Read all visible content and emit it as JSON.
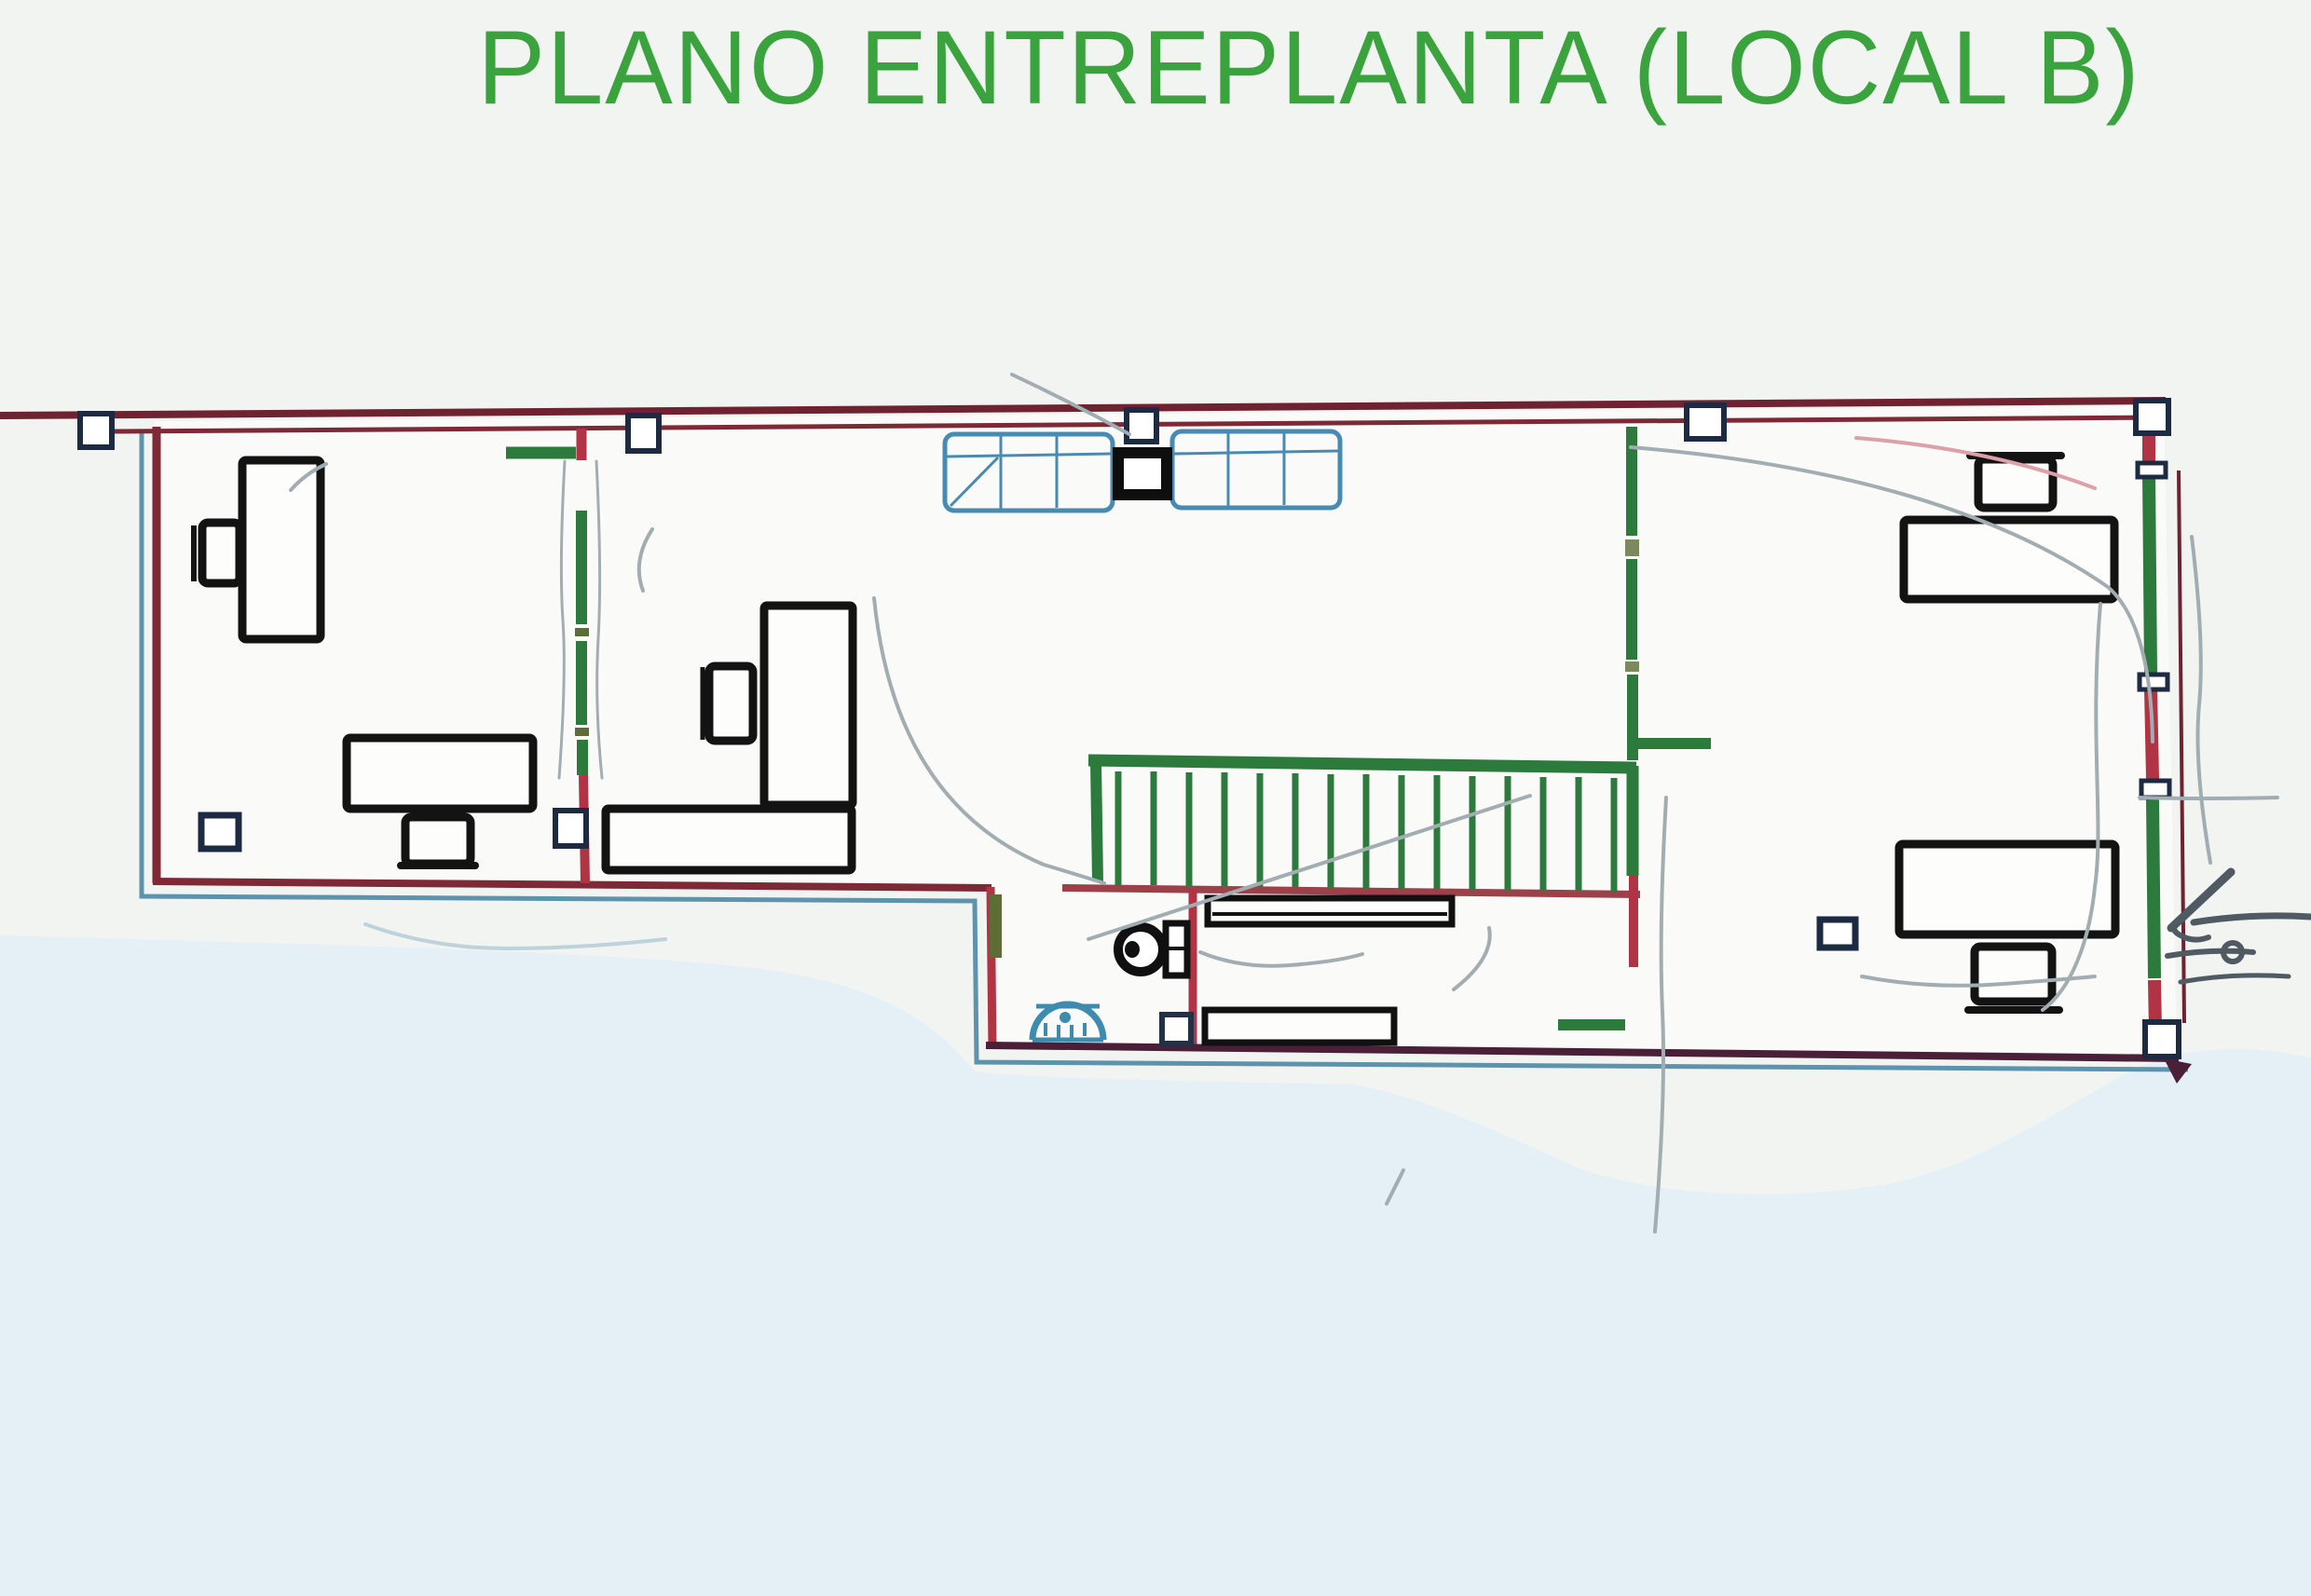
{
  "title": "PLANO ENTREPLANTA (LOCAL B)",
  "colors": {
    "title-green": "#3ba33e",
    "paper": "#f1f4f1",
    "paper-blue": "#e4eff6",
    "floor-white": "#fafbf9",
    "wall-maroon": "#6f2230",
    "wall-brick": "#7e2a36",
    "wall-dark": "#4a2038",
    "rose": "#9c4049",
    "accent-red": "#b03444",
    "accent-green": "#2c7a3c",
    "outline-blue": "#5e93ad",
    "skylight-blue": "#478bb3",
    "fixture-blue": "#3d8cb0",
    "furniture-black": "#131313",
    "column-navy": "#1d2b42",
    "door-olive": "#5e6d36",
    "pencil-gray": "#a2adb2",
    "pencil-dark": "#4f5a62",
    "pencil-red": "#dba0a8",
    "pencil-blue": "#bdd2da"
  }
}
